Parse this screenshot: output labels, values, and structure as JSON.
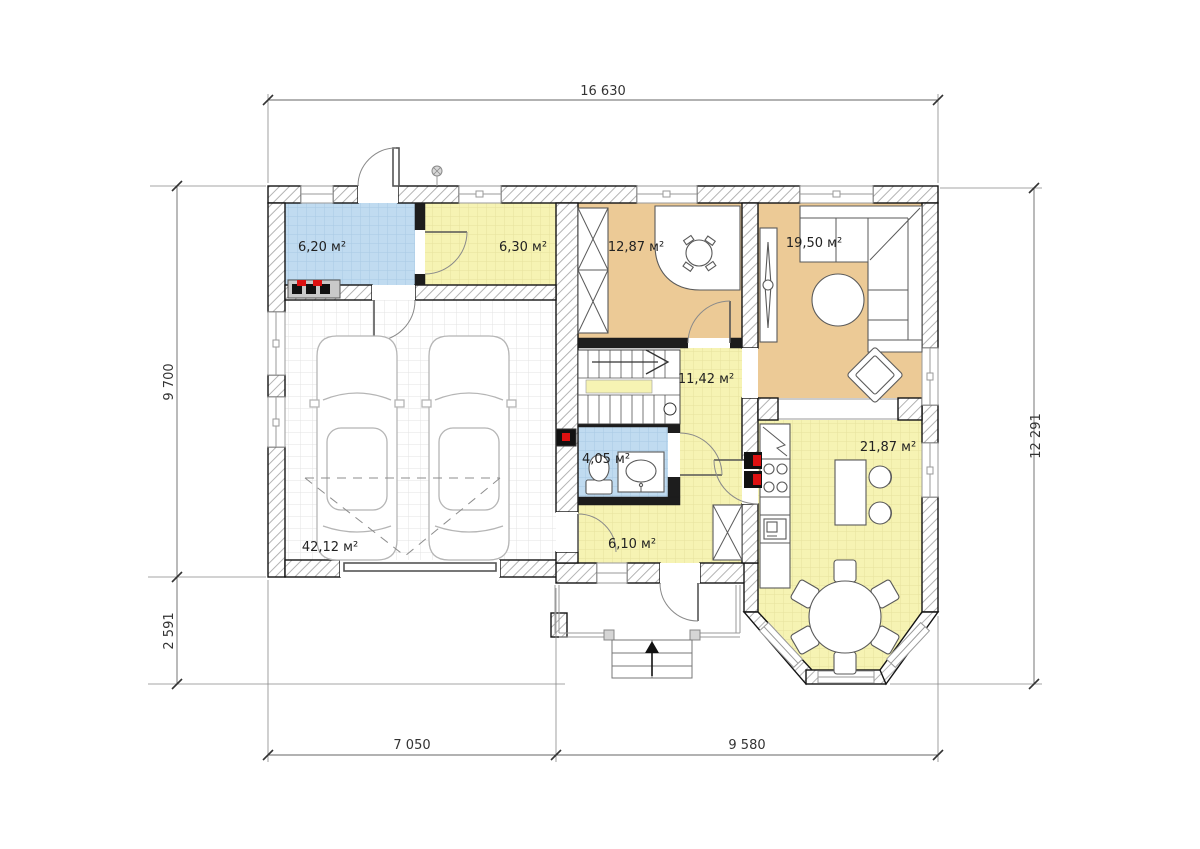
{
  "plan": {
    "rooms": [
      {
        "id": "boiler-room",
        "area_label": "6,20 м²"
      },
      {
        "id": "pantry",
        "area_label": "6,30 м²"
      },
      {
        "id": "study",
        "area_label": "12,87 м²"
      },
      {
        "id": "living-room",
        "area_label": "19,50 м²"
      },
      {
        "id": "stair-hall",
        "area_label": "11,42 м²"
      },
      {
        "id": "bathroom",
        "area_label": "4,05 м²"
      },
      {
        "id": "corridor",
        "area_label": "6,10 м²"
      },
      {
        "id": "garage",
        "area_label": "42,12 м²"
      },
      {
        "id": "kitchen-dining",
        "area_label": "21,87 м²"
      }
    ],
    "dimensions": {
      "top_width": "16 630",
      "left_height_upper": "9 700",
      "left_height_lower": "2 591",
      "right_height": "12 291",
      "bottom_width_left": "7 050",
      "bottom_width_right": "9 580"
    },
    "colors": {
      "room_tan": "#ecca96",
      "room_yellow": "#f6f3b3",
      "room_blue": "#c0dbf0",
      "wall_line": "#141414",
      "accent_red": "#dd1111"
    }
  }
}
